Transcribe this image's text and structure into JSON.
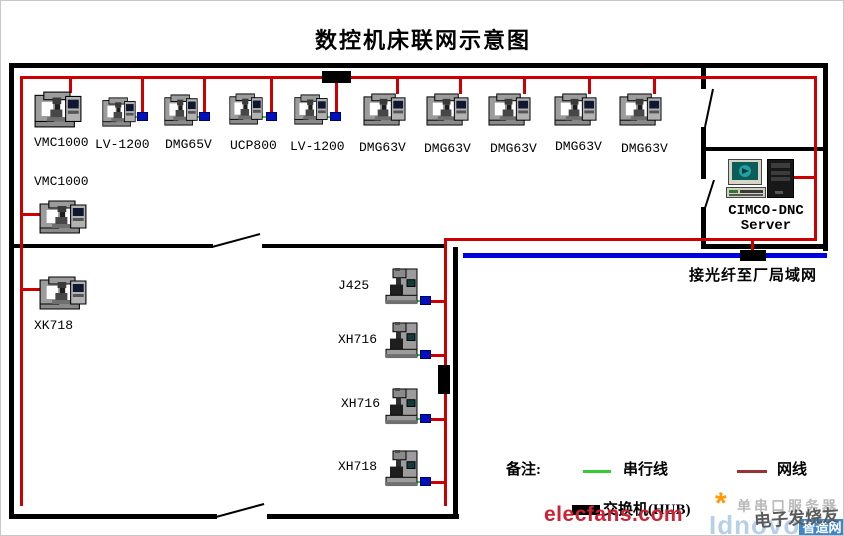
{
  "title": "数控机床联网示意图",
  "colors": {
    "wall": "#000000",
    "network_cable": "#cc0000",
    "serial_cable": "#33cc33",
    "fiber_line": "#0000dd",
    "converter_box": "#0011bb",
    "hub_box": "#000000",
    "legend_network": "#993333",
    "watermark_red": "#cc2233",
    "watermark_blue": "#b8cfe8",
    "badge_blue": "#3e86c8"
  },
  "machines": [
    {
      "group": "top-row",
      "label": "VMC1000",
      "type": "lathe",
      "icon": {
        "x": 33,
        "y": 90,
        "w": 48,
        "h": 37
      },
      "label_pos": {
        "x": 33,
        "y": 135
      },
      "drop": {
        "x": 68,
        "y": 78,
        "h": 14
      }
    },
    {
      "group": "top-row",
      "label": "LV-1200",
      "type": "lathe",
      "icon": {
        "x": 101,
        "y": 96,
        "w": 34,
        "h": 30
      },
      "label_pos": {
        "x": 94,
        "y": 137
      },
      "drop": {
        "x": 140,
        "y": 78,
        "h": 36
      },
      "converter": {
        "x": 136,
        "y": 111
      },
      "serial": {
        "x": 132,
        "y": 115,
        "w": 5
      }
    },
    {
      "group": "top-row",
      "label": "DMG65V",
      "type": "lathe",
      "icon": {
        "x": 163,
        "y": 93,
        "w": 34,
        "h": 32
      },
      "label_pos": {
        "x": 164,
        "y": 137
      },
      "drop": {
        "x": 202,
        "y": 78,
        "h": 35
      },
      "converter": {
        "x": 198,
        "y": 111
      },
      "serial": {
        "x": 194,
        "y": 115,
        "w": 5
      }
    },
    {
      "group": "top-row",
      "label": "UCP800",
      "type": "lathe",
      "icon": {
        "x": 228,
        "y": 92,
        "w": 34,
        "h": 32
      },
      "label_pos": {
        "x": 229,
        "y": 138
      },
      "drop": {
        "x": 269,
        "y": 78,
        "h": 35
      },
      "converter": {
        "x": 265,
        "y": 111
      },
      "serial": {
        "x": 259,
        "y": 115,
        "w": 7
      }
    },
    {
      "group": "top-row",
      "label": "LV-1200",
      "type": "lathe",
      "icon": {
        "x": 293,
        "y": 93,
        "w": 34,
        "h": 31
      },
      "label_pos": {
        "x": 289,
        "y": 139
      },
      "drop": {
        "x": 334,
        "y": 80,
        "h": 33
      },
      "converter": {
        "x": 329,
        "y": 111
      },
      "serial": {
        "x": 324,
        "y": 115,
        "w": 6
      }
    },
    {
      "group": "top-row",
      "label": "DMG63V",
      "type": "lathe",
      "icon": {
        "x": 362,
        "y": 92,
        "w": 43,
        "h": 33
      },
      "label_pos": {
        "x": 358,
        "y": 140
      },
      "drop": {
        "x": 395,
        "y": 78,
        "h": 15
      }
    },
    {
      "group": "top-row",
      "label": "DMG63V",
      "type": "lathe",
      "icon": {
        "x": 425,
        "y": 92,
        "w": 43,
        "h": 33
      },
      "label_pos": {
        "x": 423,
        "y": 141
      },
      "drop": {
        "x": 458,
        "y": 78,
        "h": 15
      }
    },
    {
      "group": "top-row",
      "label": "DMG63V",
      "type": "lathe",
      "icon": {
        "x": 487,
        "y": 92,
        "w": 43,
        "h": 33
      },
      "label_pos": {
        "x": 489,
        "y": 141
      },
      "drop": {
        "x": 522,
        "y": 78,
        "h": 15
      }
    },
    {
      "group": "top-row",
      "label": "DMG63V",
      "type": "lathe",
      "icon": {
        "x": 553,
        "y": 92,
        "w": 43,
        "h": 33
      },
      "label_pos": {
        "x": 554,
        "y": 139
      },
      "drop": {
        "x": 587,
        "y": 78,
        "h": 15
      }
    },
    {
      "group": "top-row",
      "label": "DMG63V",
      "type": "lathe",
      "icon": {
        "x": 618,
        "y": 92,
        "w": 43,
        "h": 33
      },
      "label_pos": {
        "x": 620,
        "y": 141
      },
      "drop": {
        "x": 652,
        "y": 78,
        "h": 15
      }
    },
    {
      "group": "left-column",
      "label": "VMC1000",
      "type": "lathe",
      "icon": {
        "x": 38,
        "y": 199,
        "w": 48,
        "h": 34
      },
      "label_pos": {
        "x": 33,
        "y": 174
      },
      "stub": {
        "x": 21,
        "y": 212,
        "w": 18
      }
    },
    {
      "group": "left-column",
      "label": "XK718",
      "type": "lathe",
      "icon": {
        "x": 38,
        "y": 275,
        "w": 48,
        "h": 34
      },
      "label_pos": {
        "x": 33,
        "y": 318
      },
      "stub": {
        "x": 21,
        "y": 287,
        "w": 18
      }
    },
    {
      "group": "middle-column",
      "label": "J425",
      "type": "mill",
      "icon": {
        "x": 384,
        "y": 267,
        "w": 34,
        "h": 39
      },
      "label_pos": {
        "x": 337,
        "y": 278
      },
      "converter": {
        "x": 419,
        "y": 295
      },
      "serial": {
        "x": 415,
        "y": 299,
        "w": 5
      },
      "stub": {
        "x": 430,
        "y": 299,
        "w": 13
      }
    },
    {
      "group": "middle-column",
      "label": "XH716",
      "type": "mill",
      "icon": {
        "x": 384,
        "y": 321,
        "w": 34,
        "h": 39
      },
      "label_pos": {
        "x": 337,
        "y": 332
      },
      "converter": {
        "x": 419,
        "y": 349
      },
      "serial": {
        "x": 415,
        "y": 353,
        "w": 5
      },
      "stub": {
        "x": 430,
        "y": 353,
        "w": 13
      }
    },
    {
      "group": "middle-column",
      "label": "XH716",
      "type": "mill",
      "icon": {
        "x": 384,
        "y": 387,
        "w": 34,
        "h": 39
      },
      "label_pos": {
        "x": 340,
        "y": 396
      },
      "converter": {
        "x": 419,
        "y": 413
      },
      "serial": {
        "x": 415,
        "y": 417,
        "w": 5
      },
      "stub": {
        "x": 430,
        "y": 417,
        "w": 13
      }
    },
    {
      "group": "middle-column",
      "label": "XH718",
      "type": "mill",
      "icon": {
        "x": 384,
        "y": 449,
        "w": 34,
        "h": 39
      },
      "label_pos": {
        "x": 337,
        "y": 459
      },
      "converter": {
        "x": 419,
        "y": 476
      },
      "serial": {
        "x": 415,
        "y": 480,
        "w": 5
      },
      "stub": {
        "x": 430,
        "y": 480,
        "w": 13
      }
    }
  ],
  "server": {
    "name_line1": "CIMCO-DNC",
    "name_line2": "Server"
  },
  "fiber": {
    "label": "接光纤至厂局域网"
  },
  "legend": {
    "title": "备注:",
    "serial_label": "串行线",
    "network_label": "网线",
    "hub_label": "交换机(HUB)"
  },
  "watermarks": {
    "site": "elecfans.com",
    "site_cn": "电子发烧友",
    "gray_text": "单串口服务器",
    "brand": "Idnovo",
    "brand_badge": "智造网",
    "star": "*"
  }
}
